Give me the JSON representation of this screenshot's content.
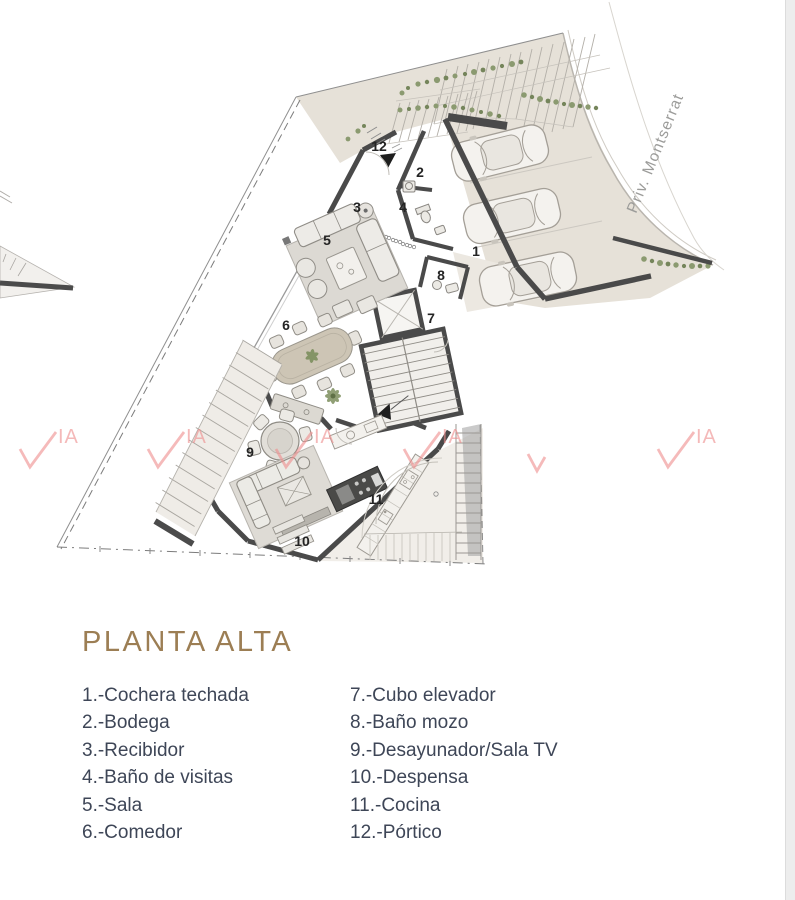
{
  "header": {
    "title": "PLANTA ALTA"
  },
  "plan": {
    "street_label": "Priv. Montserrat",
    "watermark_letters": "IA",
    "room_labels": [
      {
        "n": "1",
        "x": 476,
        "y": 256
      },
      {
        "n": "2",
        "x": 420,
        "y": 177
      },
      {
        "n": "3",
        "x": 357,
        "y": 212
      },
      {
        "n": "4",
        "x": 403,
        "y": 212
      },
      {
        "n": "5",
        "x": 327,
        "y": 245
      },
      {
        "n": "6",
        "x": 286,
        "y": 330
      },
      {
        "n": "7",
        "x": 431,
        "y": 323
      },
      {
        "n": "8",
        "x": 441,
        "y": 280
      },
      {
        "n": "9",
        "x": 250,
        "y": 457
      },
      {
        "n": "10",
        "x": 302,
        "y": 546
      },
      {
        "n": "11",
        "x": 376,
        "y": 504
      },
      {
        "n": "12",
        "x": 379,
        "y": 151
      }
    ],
    "watermarks": [
      {
        "x": 20,
        "y": 433,
        "partial": false
      },
      {
        "x": 148,
        "y": 433,
        "partial": false
      },
      {
        "x": 276,
        "y": 433,
        "partial": false
      },
      {
        "x": 404,
        "y": 433,
        "partial": false
      },
      {
        "x": 528,
        "y": 440,
        "partial": true
      },
      {
        "x": 658,
        "y": 433,
        "partial": false
      }
    ]
  },
  "legend": {
    "col1": [
      "1.-Cochera techada",
      "2.-Bodega",
      "3.-Recibidor",
      "4.-Baño de visitas",
      "5.-Sala",
      "6.-Comedor"
    ],
    "col2": [
      "7.-Cubo elevador",
      "8.-Baño mozo",
      "9.-Desayunador/Sala TV",
      "10.-Despensa",
      "11.-Cocina",
      "12.-Pórtico"
    ]
  },
  "colors": {
    "title": "#9c7e54",
    "legend_text": "#3e4657",
    "watermark": "#ee8c8c",
    "wall": "#4a4a4a",
    "paving": "#e6e1d8"
  }
}
